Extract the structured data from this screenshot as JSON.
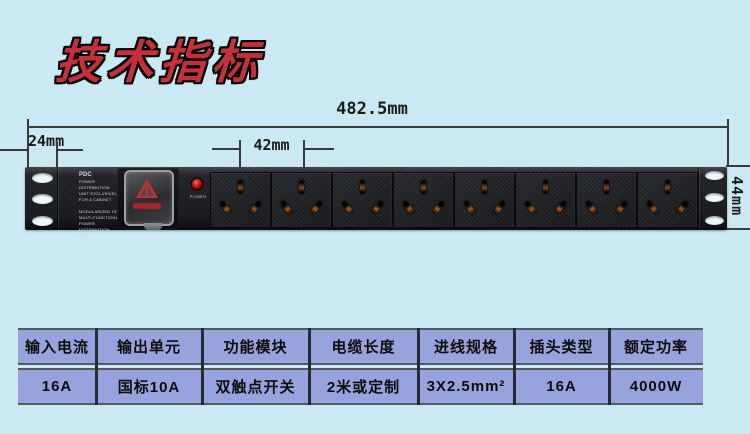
{
  "page": {
    "background_color": "#cbe9f2"
  },
  "title": {
    "text": "技术指标",
    "color": "#c5303c"
  },
  "dimensions": {
    "total_width": "482.5mm",
    "left_offset": "24mm",
    "outlet_pitch": "42mm",
    "height": "44mm"
  },
  "pdu": {
    "outlet_count": 8,
    "label": {
      "brand": "PDC",
      "block1": "POWER DISTRIBUTION\nUNIT EXCLUSIVELY\nFOR A CABINET",
      "block2": "MODULARIZED 19IN\nMULTI-FUNCTIONAL\nPOWER DISTRIBUTION\nUNIT"
    },
    "led_label": "POWER"
  },
  "spec_table": {
    "columns": [
      {
        "header": "输入电流",
        "value": "16A"
      },
      {
        "header": "输出单元",
        "value": "国标10A"
      },
      {
        "header": "功能模块",
        "value": "双触点开关"
      },
      {
        "header": "电缆长度",
        "value": "2米或定制"
      },
      {
        "header": "进线规格",
        "value": "3X2.5mm²"
      },
      {
        "header": "插头类型",
        "value": "16A"
      },
      {
        "header": "额定功率",
        "value": "4000W"
      }
    ]
  }
}
